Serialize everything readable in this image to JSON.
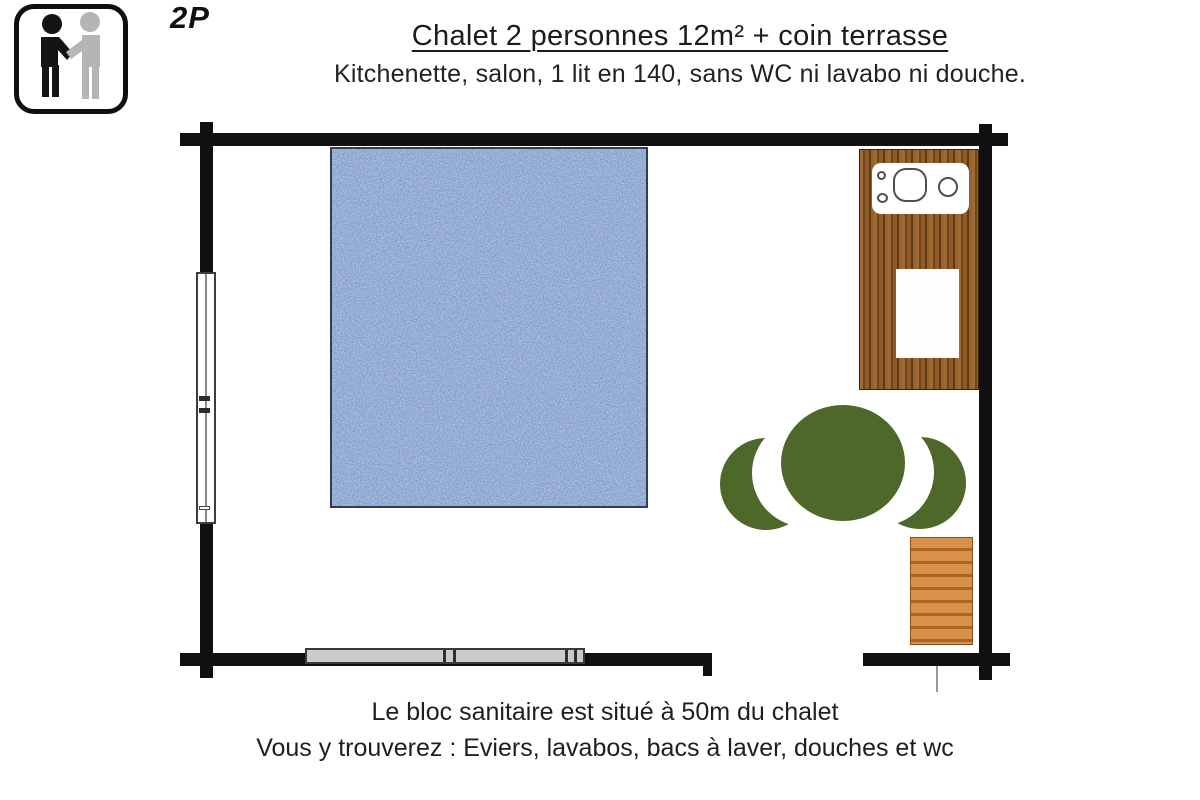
{
  "occupancy": {
    "badge": "2P",
    "icon": "two-persons-icon"
  },
  "header": {
    "title": "Chalet 2 personnes 12m² + coin terrasse",
    "subtitle": "Kitchenette, salon, 1 lit en 140, sans WC ni lavabo ni douche."
  },
  "floorplan": {
    "features": [
      "double-bed",
      "left-wall-window",
      "bottom-wall-window",
      "kitchenette-counter",
      "cooktop-sink",
      "side-table",
      "plant",
      "terrace-steps",
      "door-opening"
    ],
    "colors": {
      "wall": "#101010",
      "bed_fabric": "#5b7dbb",
      "counter_wood": "#8a5c2c",
      "steps_wood": "#d9904a",
      "plant_green": "#4d6829"
    }
  },
  "footer": {
    "line1": "Le bloc sanitaire est situé à 50m du chalet",
    "line2": "Vous y trouverez : Eviers, lavabos, bacs à laver, douches et wc"
  }
}
